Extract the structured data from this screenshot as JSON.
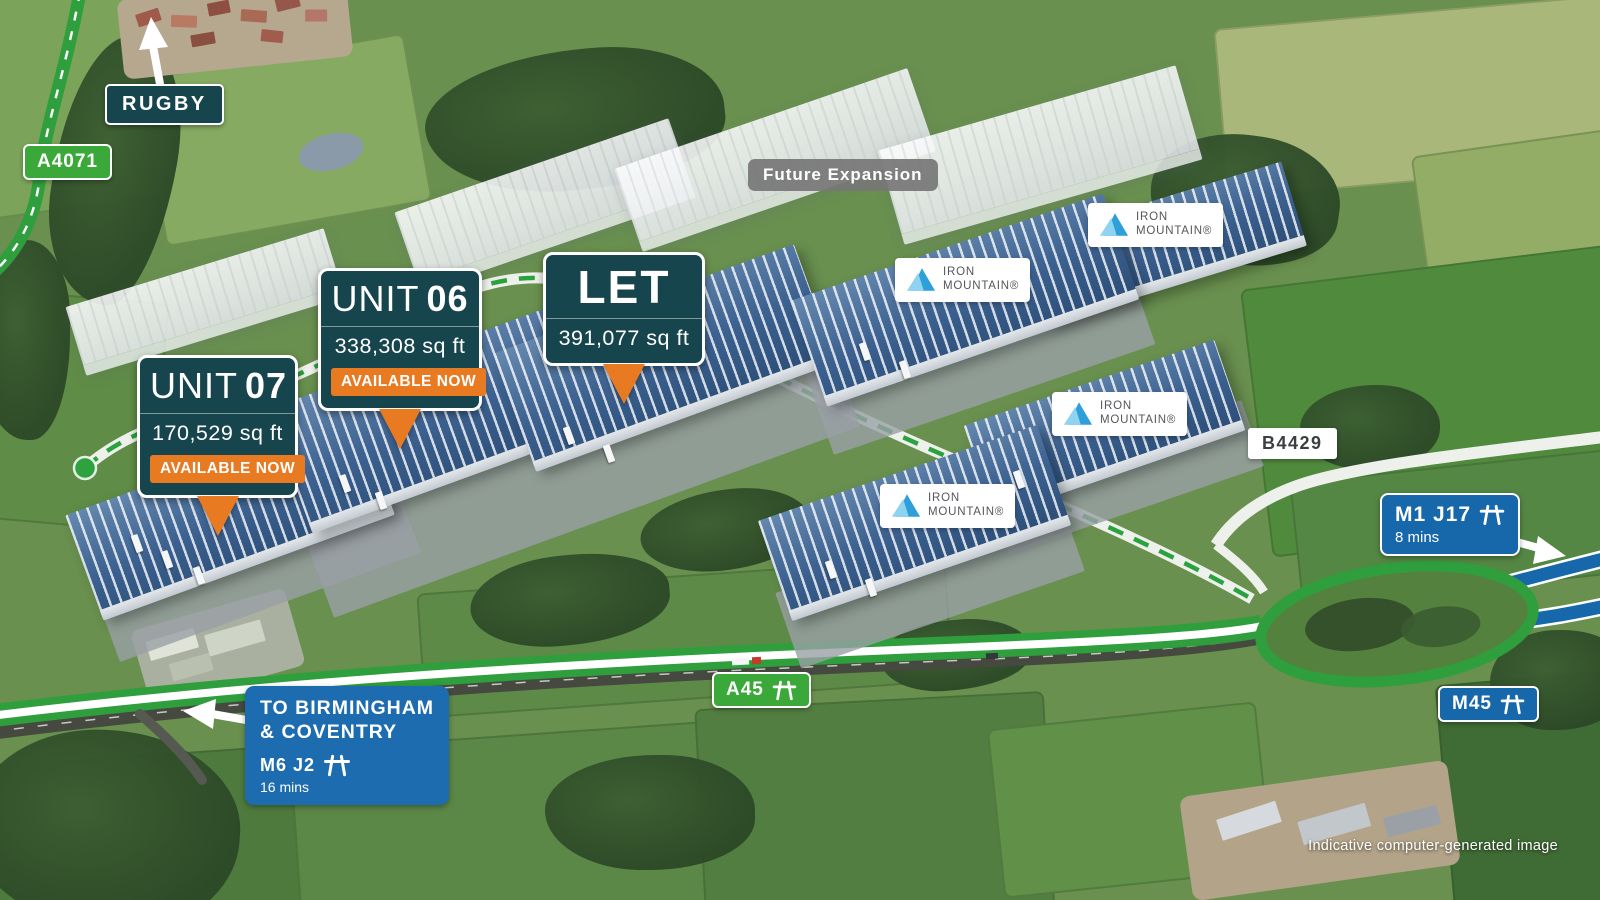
{
  "colors": {
    "callout_teal": "#17454e",
    "badge_orange": "#e87a22",
    "sign_blue": "#1767ab",
    "sign_green": "#3aa93a",
    "route_green": "#2f9e3d",
    "dash_green": "#2aa33e",
    "sign_gray": "#767676",
    "logo_blue_light": "#8ed4f0",
    "logo_blue": "#2e9fd8"
  },
  "signs": {
    "rugby": {
      "label": "RUGBY"
    },
    "a4071": {
      "label": "A4071"
    },
    "future_expansion": {
      "label": "Future Expansion"
    },
    "b4429": {
      "label": "B4429"
    },
    "a45": {
      "label": "A45"
    },
    "m45": {
      "label": "M45"
    },
    "m1_j17": {
      "label": "M1 J17",
      "time": "8 mins"
    },
    "birmingham": {
      "line1": "TO BIRMINGHAM",
      "line2": "& COVENTRY",
      "junction": "M6 J2",
      "time": "16 mins"
    }
  },
  "callouts": {
    "unit06": {
      "prefix": "UNIT",
      "number": "06",
      "area": "338,308 sq ft",
      "badge": "AVAILABLE NOW"
    },
    "unit07": {
      "prefix": "UNIT",
      "number": "07",
      "area": "170,529 sq ft",
      "badge": "AVAILABLE NOW"
    },
    "let_unit": {
      "title": "LET",
      "area": "391,077 sq ft"
    }
  },
  "logo": {
    "iron_mountain": {
      "line1": "IRON",
      "line2": "MOUNTAIN®"
    }
  },
  "footnote": "Indicative computer-generated image"
}
